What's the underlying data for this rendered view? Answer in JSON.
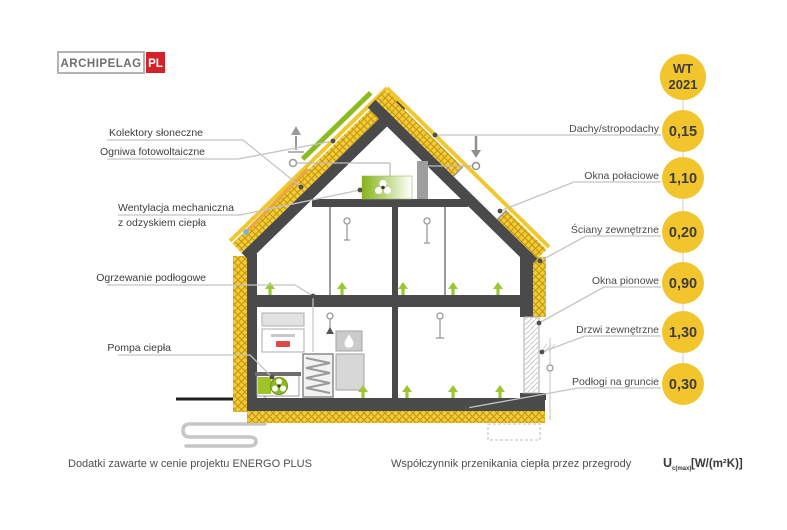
{
  "logo": {
    "name": "ARCHIPELAG",
    "suffix": "PL"
  },
  "badge": {
    "line1": "WT",
    "line2": "2021"
  },
  "left_labels": {
    "solar_collectors": "Kolektory słoneczne",
    "photovoltaic": "Ogniwa fotowoltaiczne",
    "ventilation_line1": "Wentylacja mechaniczna",
    "ventilation_line2": "z odzyskiem ciepła",
    "floor_heating": "Ogrzewanie podłogowe",
    "heat_pump": "Pompa ciepła"
  },
  "right_labels": [
    {
      "label": "Dachy/stropodachy",
      "value": "0,15"
    },
    {
      "label": "Okna połaciowe",
      "value": "1,10"
    },
    {
      "label": "Ściany zewnętrzne",
      "value": "0,20"
    },
    {
      "label": "Okna pionowe",
      "value": "0,90"
    },
    {
      "label": "Drzwi zewnętrzne",
      "value": "1,30"
    },
    {
      "label": "Podłogi na gruncie",
      "value": "0,30"
    }
  ],
  "footer": {
    "left": "Dodatki zawarte w cenie projektu ENERGO PLUS",
    "right": "Współczynnik przenikania ciepła przez przegrody",
    "u_symbol": "U",
    "u_sub": "c(max)",
    "u_units": "[W/(m²K)]"
  },
  "colors": {
    "accent_yellow": "#F2C52C",
    "insulation_yellow": "#F3CD32",
    "eco_green": "#8CBB1F",
    "arrow_green": "#9BC832",
    "structure_gray": "#4A4A4A",
    "logo_red": "#D3222A"
  }
}
